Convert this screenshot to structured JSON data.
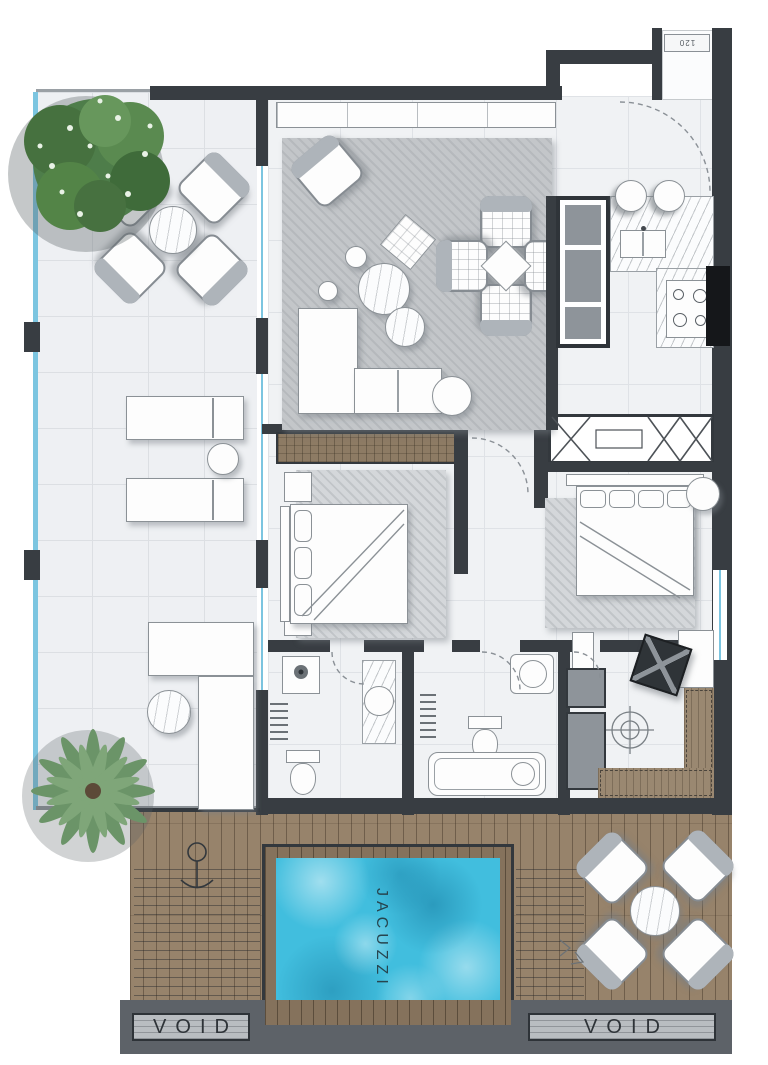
{
  "labels": {
    "jacuzzi": "JACUZZI",
    "void_left": "VOID",
    "void_right": "VOID",
    "unit_number": "120"
  },
  "colors": {
    "wall": "#383d42",
    "marble_floor": "#eef0f3",
    "deck_wood": "#97836b",
    "pool_water": "#41bede",
    "glass_glazing": "#7cc5e0",
    "wardrobe_wood": "#8d7b64",
    "living_rug": "#c3c6c9",
    "void_band": "#5d6268",
    "tree_green": "#4e7d4a",
    "palm_green": "#6b9468"
  },
  "icons": {
    "tree": "tree-icon",
    "palm": "palm-tree-icon",
    "shower_head": "shower-head-icon",
    "floor_drain": "floor-drain-icon",
    "hammock_anchor": "hammock-anchor-icon",
    "door_swing": "door-swing-arc"
  }
}
